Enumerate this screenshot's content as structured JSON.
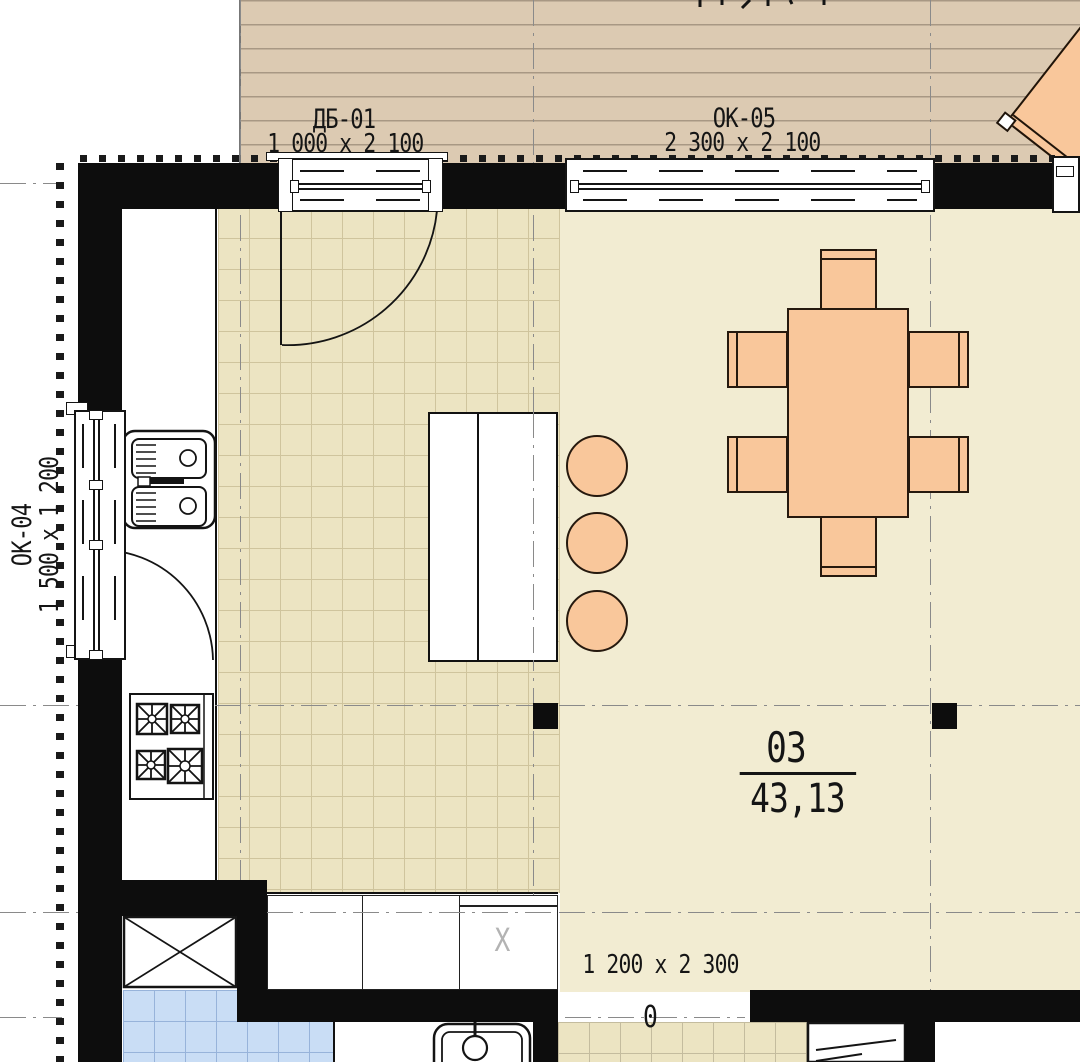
{
  "windows": [
    {
      "code": "ДБ-01",
      "size": "1 000 x 2 100"
    },
    {
      "code": "ОК-05",
      "size": "2 300 x 2 100"
    },
    {
      "code": "ОК-04",
      "size": "1 500 x 1 200"
    }
  ],
  "room": {
    "number": "03",
    "area": "43,13"
  },
  "door": {
    "size": "1 200 x 2 300",
    "threshold": "0"
  },
  "markers": {
    "cabinet_x": "X"
  },
  "colors": {
    "wall": "#0d0d0d",
    "terrace_deck": "#dccab2",
    "kitchen_floor": "#ece4c2",
    "living_floor": "#f2ecd2",
    "bathroom_floor": "#c9ddf5",
    "furniture": "#f9c79b",
    "axis_line": "#8a8a8a"
  }
}
